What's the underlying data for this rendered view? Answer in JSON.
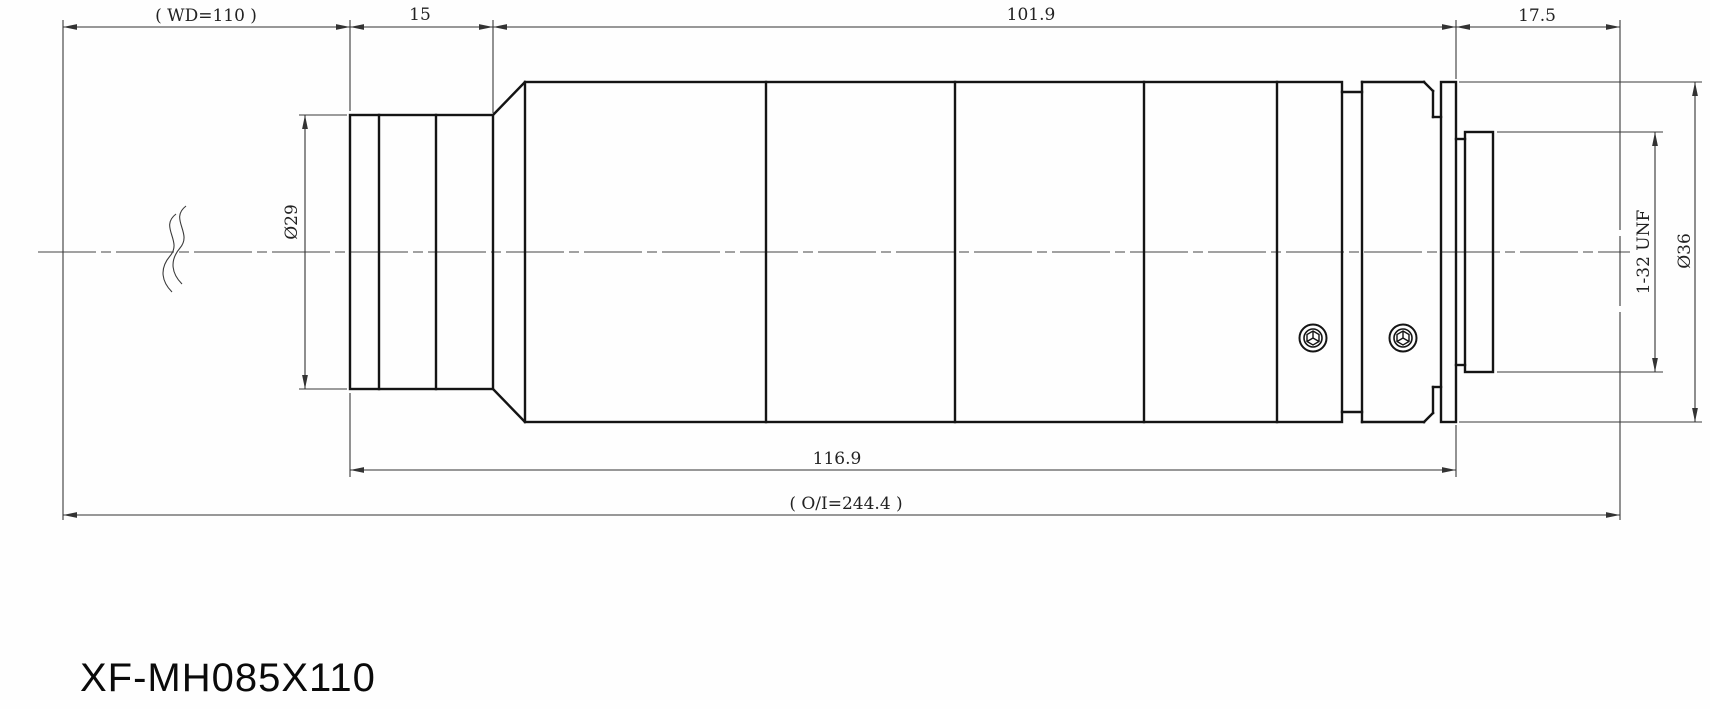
{
  "drawing_title": "XF-MH085X110",
  "dimensions": {
    "working_distance": "( WD=110 )",
    "front_section_length": "15",
    "body_length": "101.9",
    "rear_section_length": "17.5",
    "front_diameter": "Ø29",
    "rear_thread": "1-32 UNF",
    "body_diameter": "Ø36",
    "mechanical_length": "116.9",
    "object_image_distance": "( O/I=244.4 )"
  },
  "colors": {
    "outline": "#141414",
    "dimension_line": "#333333",
    "background": "#fefefe"
  }
}
